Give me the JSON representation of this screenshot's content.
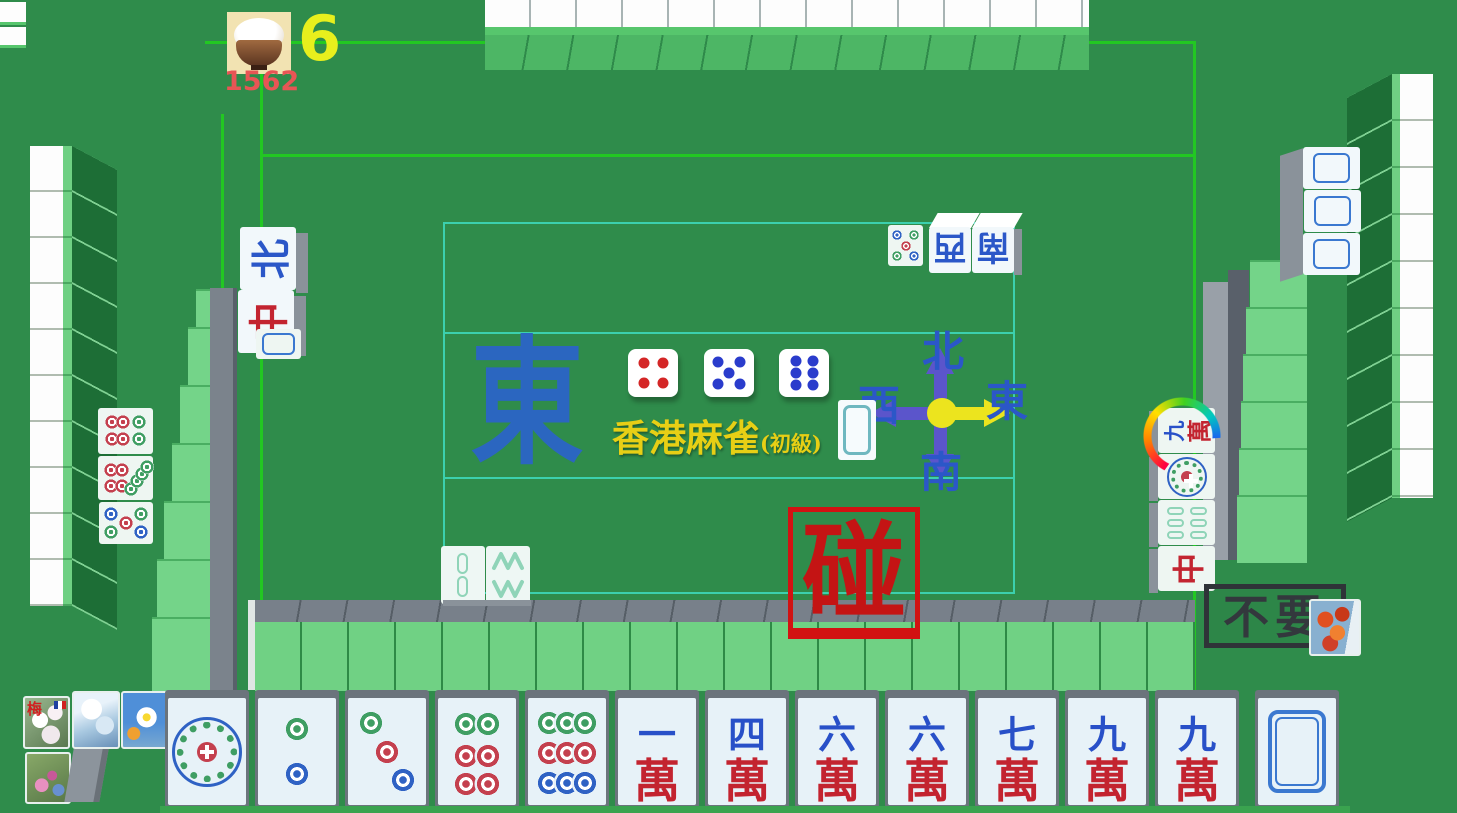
{
  "hud": {
    "count": "6",
    "score": "1562",
    "icon": "rice-bowl-icon"
  },
  "center": {
    "round_wind": "東",
    "title": "香港麻雀",
    "title_suffix": "(初級)",
    "dice": [
      {
        "value": 4,
        "pip_color": "#d42626"
      },
      {
        "value": 5,
        "pip_color": "#2a3ccc"
      },
      {
        "value": 6,
        "pip_color": "#2a3ccc"
      }
    ],
    "compass": {
      "north": "北",
      "south": "南",
      "west": "西",
      "east": "東",
      "active_direction": "east"
    }
  },
  "actions": {
    "pong": "碰",
    "pass": "不要"
  },
  "hand": {
    "tiles": [
      {
        "kind": "dots",
        "value": 1
      },
      {
        "kind": "dots",
        "value": 2
      },
      {
        "kind": "dots",
        "value": 3
      },
      {
        "kind": "dots",
        "value": 6
      },
      {
        "kind": "dots",
        "value": 9
      },
      {
        "kind": "wan",
        "num": "一",
        "suit": "萬"
      },
      {
        "kind": "wan",
        "num": "四",
        "suit": "萬"
      },
      {
        "kind": "wan",
        "num": "六",
        "suit": "萬"
      },
      {
        "kind": "wan",
        "num": "六",
        "suit": "萬"
      },
      {
        "kind": "wan",
        "num": "七",
        "suit": "萬"
      },
      {
        "kind": "wan",
        "num": "九",
        "suit": "萬"
      },
      {
        "kind": "wan",
        "num": "九",
        "suit": "萬"
      },
      {
        "kind": "white",
        "drawn": true
      }
    ],
    "flowers": [
      {
        "label": "梅"
      },
      {
        "label": ""
      },
      {
        "label": ""
      },
      {
        "label": ""
      }
    ]
  },
  "discards": {
    "left": {
      "wind": "北",
      "dragon": "中",
      "tiles": [
        "north-wind",
        "red-dragon",
        "white-dragon",
        "6-dots",
        "8-dots",
        "5-dots"
      ]
    },
    "top": {
      "west": "西",
      "south": "南",
      "tiles": [
        "5-dots",
        "west-wind",
        "south-wind"
      ]
    },
    "right": {
      "nine": "九",
      "wan": "萬",
      "dragon": "中",
      "tiles": [
        "9-wan",
        "1-dot",
        "6-bamboo",
        "red-dragon"
      ]
    },
    "bottom": {
      "tiles": [
        "2-bamboo",
        "8-bamboo"
      ]
    },
    "center": {
      "tiles": [
        "white-dragon"
      ]
    },
    "last_discard_indicator": "rainbow-arc-on-9-wan"
  },
  "melds": {
    "right_player": {
      "type": "pong",
      "tile": "white-dragon",
      "count": 3
    }
  },
  "colors": {
    "table_green": "#2f8c4b",
    "line_green": "#22c822",
    "line_teal": "#3cd0ae",
    "pong_red": "#cc1616",
    "pass_dark": "#33383d",
    "wind_blue": "#2b57c8",
    "wan_red": "#c32430",
    "title_yellow": "#e7cf15",
    "count_yellow": "#e8ef1d",
    "score_red": "#e85555",
    "east_arrow_yellow": "#ece41e",
    "compass_purple": "#5b55cb"
  }
}
